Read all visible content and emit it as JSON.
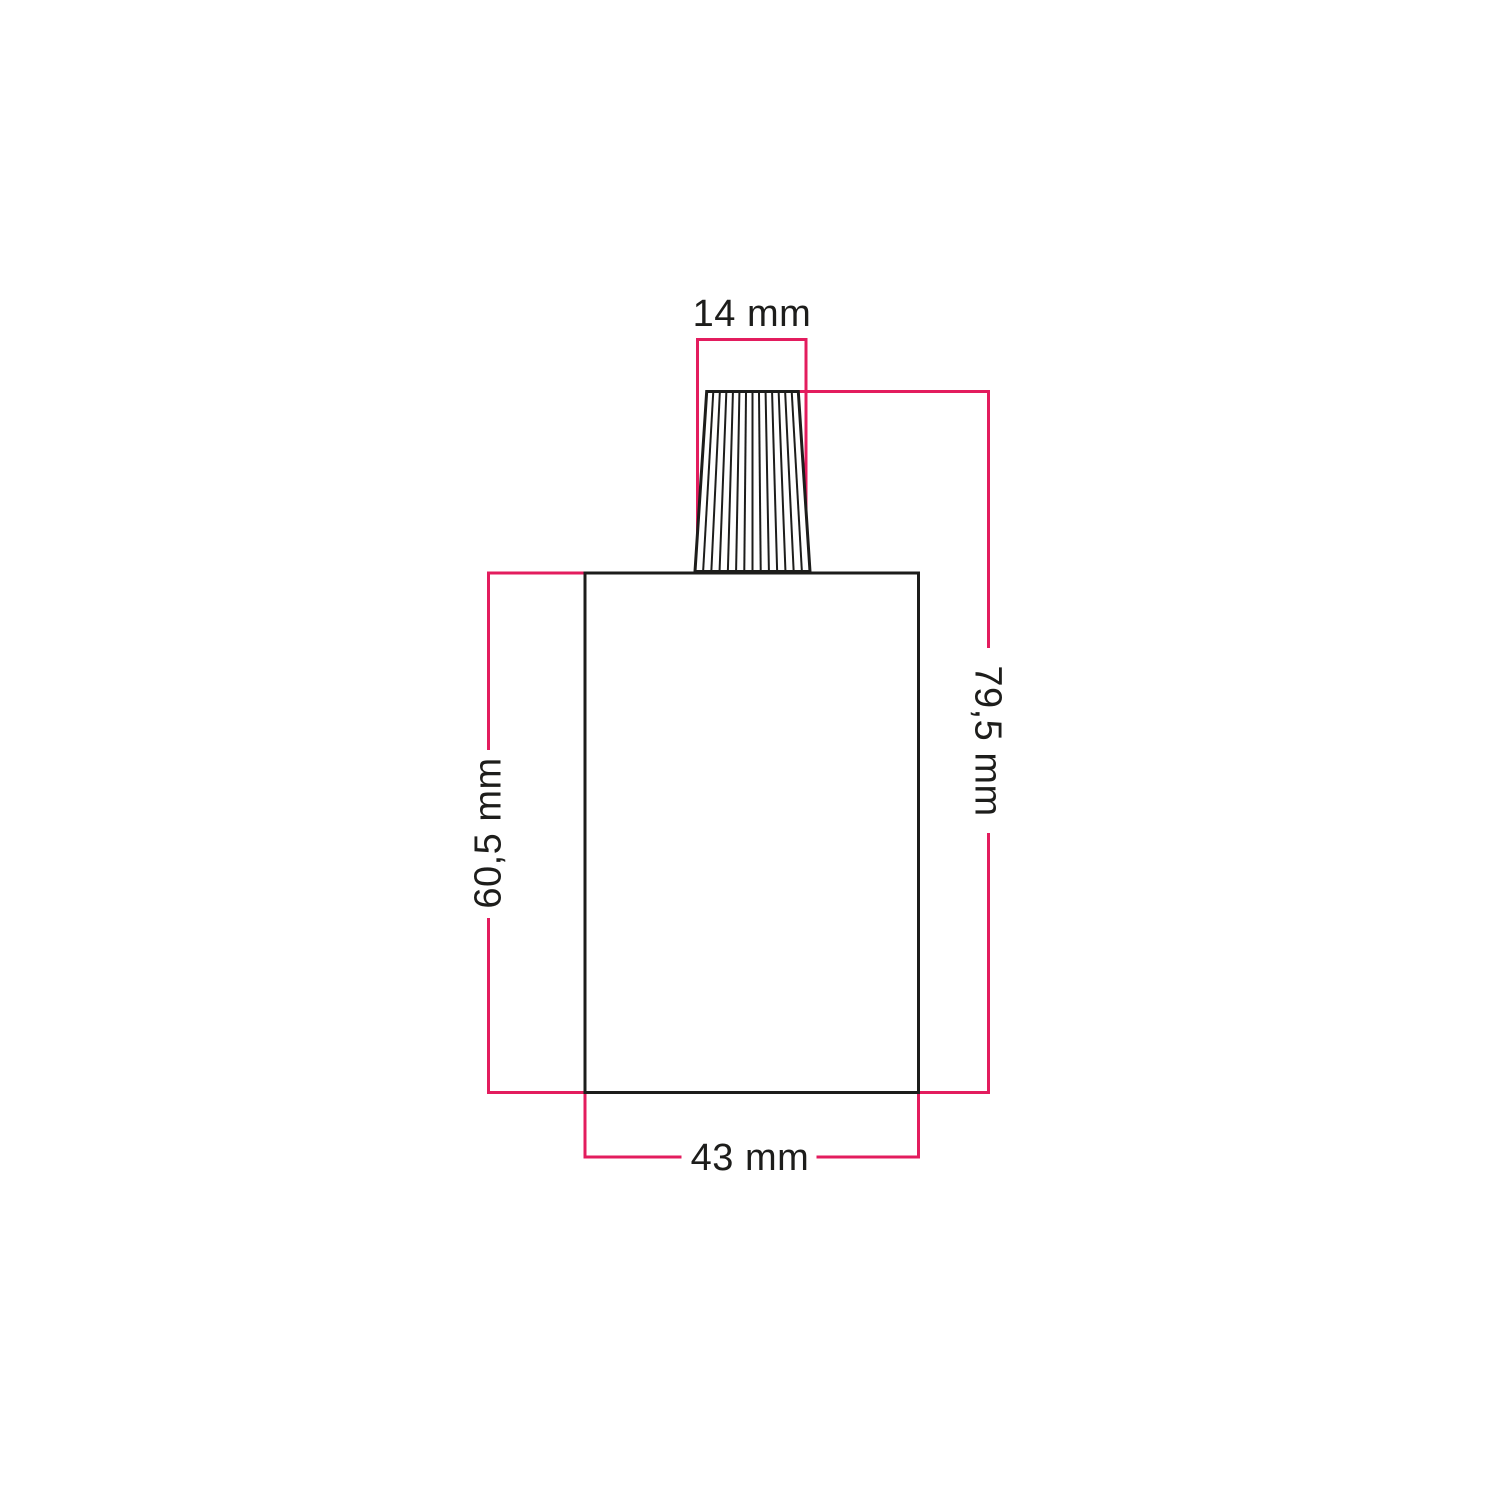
{
  "page": {
    "background": "#ffffff"
  },
  "colors": {
    "dimension_line": "#e31c5e",
    "outline": "#1d1d1b",
    "label_text": "#1d1d1b"
  },
  "labels": {
    "top_width": "14 mm",
    "total_height": "79,5 mm",
    "body_height": "60,5 mm",
    "body_width": "43 mm"
  }
}
